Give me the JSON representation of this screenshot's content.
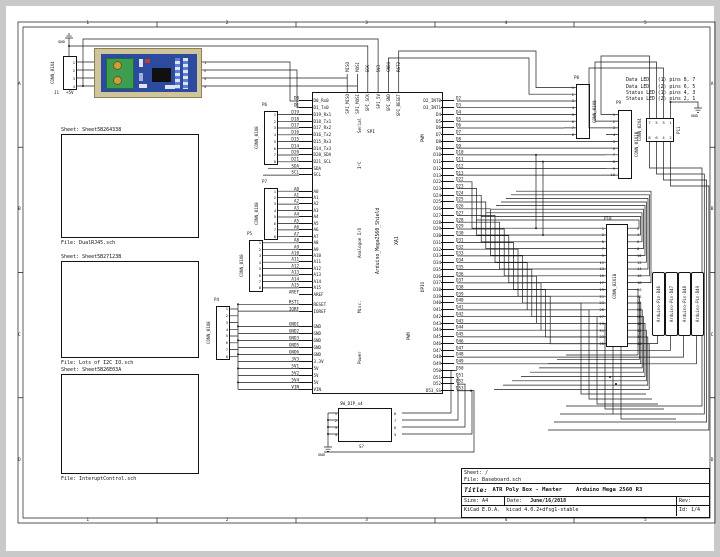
{
  "frame": {
    "cols": [
      "1",
      "2",
      "3",
      "4",
      "5"
    ],
    "rows": [
      "A",
      "B",
      "C",
      "D"
    ]
  },
  "title_block": {
    "sheet": "Sheet: /",
    "file": "File: Baseboard.sch",
    "title_label": "Title:",
    "title": "ATR Poly Box - Master",
    "subtitle": "Arduino Mega 2560 R3",
    "size": "Size: A4",
    "date_label": "Date:",
    "date": "June/16/2018",
    "rev": "Rev:",
    "kicad": "KiCad E.D.A.  kicad 4.0.2+dfsg1-stable",
    "id": "Id: 1/4"
  },
  "notes": [
    "Data LED   (1) pins 8, 7",
    "Data LED   (2) pins 6, 5",
    "Status LED (1) pins 4, 3",
    "Status LED (2) pins 2, 1"
  ],
  "sheets": [
    {
      "name": "Sheet: Sheet5B264338",
      "file": "File: DualRJ45.sch"
    },
    {
      "name": "Sheet: Sheet5B27123B",
      "file": "File: Lots of I2C IO.sch"
    },
    {
      "name": "Sheet: Sheet5B26E03A",
      "file": "File: InteruptControl.sch"
    }
  ],
  "j1": {
    "ref": "J1",
    "value": "CONN_01X4",
    "gnd": "GND",
    "v5": "+5V",
    "pins": [
      "1",
      "2",
      "3",
      "4"
    ],
    "module_pins": [
      "1",
      "2",
      "3",
      "4"
    ]
  },
  "dip": {
    "ref": "S?",
    "value": "SW_DIP_x4",
    "gnd": "GND",
    "left_pins": [
      "1",
      "2",
      "3",
      "4"
    ],
    "right_pins": [
      "8",
      "7",
      "6",
      "5"
    ]
  },
  "p11_gnd": "GND",
  "arduino": {
    "ref": "XA1",
    "value": "Arduino_Mega2560_Shield",
    "top_group": "SPI",
    "pwm2_label": "PWM",
    "top_pins": [
      {
        "net": "MISO",
        "name": "SPI_MISO"
      },
      {
        "net": "MOSI",
        "name": "SPI_MOSI"
      },
      {
        "net": "SCK",
        "name": "SPI_SCK"
      },
      {
        "net": "5V3",
        "name": "SPI_5V"
      },
      {
        "net": "GND4",
        "name": "SPI_GND"
      },
      {
        "net": "RST2",
        "name": "SPI_RESET"
      }
    ],
    "left_groups": [
      {
        "label": "Serial",
        "pins": [
          {
            "net": "D0",
            "name": "D0_Rx0"
          },
          {
            "net": "D1",
            "name": "D1_Tx0"
          },
          {
            "net": "D19",
            "name": "D19_Rx1"
          },
          {
            "net": "D18",
            "name": "D18_Tx1"
          },
          {
            "net": "D17",
            "name": "D17_Rx2"
          },
          {
            "net": "D16",
            "name": "D16_Tx2"
          },
          {
            "net": "D15",
            "name": "D15_Rx3"
          },
          {
            "net": "D14",
            "name": "D14_Tx3"
          }
        ]
      },
      {
        "label": "I²C",
        "pins": [
          {
            "net": "D20",
            "name": "D20_SDA"
          },
          {
            "net": "D21",
            "name": "D21_SCL"
          },
          {
            "net": "SDA",
            "name": "SDA"
          },
          {
            "net": "SCL",
            "name": "SCL"
          }
        ]
      },
      {
        "label": "Analogue I/O",
        "pins": [
          {
            "net": "A0",
            "name": "A0"
          },
          {
            "net": "A1",
            "name": "A1"
          },
          {
            "net": "A2",
            "name": "A2"
          },
          {
            "net": "A3",
            "name": "A3"
          },
          {
            "net": "A4",
            "name": "A4"
          },
          {
            "net": "A5",
            "name": "A5"
          },
          {
            "net": "A6",
            "name": "A6"
          },
          {
            "net": "A7",
            "name": "A7"
          },
          {
            "net": "A8",
            "name": "A8"
          },
          {
            "net": "A9",
            "name": "A9"
          },
          {
            "net": "A10",
            "name": "A10"
          },
          {
            "net": "A11",
            "name": "A11"
          },
          {
            "net": "A12",
            "name": "A12"
          },
          {
            "net": "A13",
            "name": "A13"
          },
          {
            "net": "A14",
            "name": "A14"
          },
          {
            "net": "A15",
            "name": "A15"
          },
          {
            "net": "AREF",
            "name": "AREF"
          }
        ]
      },
      {
        "label": "Misc.",
        "pins": [
          {
            "net": "RST1",
            "name": "RESET"
          },
          {
            "net": "IORF",
            "name": "IOREF"
          }
        ]
      },
      {
        "label": "Power",
        "pins": [
          {
            "net": "GND1",
            "name": "GND"
          },
          {
            "net": "GND2",
            "name": "GND"
          },
          {
            "net": "GND3",
            "name": "GND"
          },
          {
            "net": "GND5",
            "name": "GND"
          },
          {
            "net": "GND6",
            "name": "GND"
          },
          {
            "net": "3V3",
            "name": "3.3V"
          },
          {
            "net": "5V1",
            "name": "5V"
          },
          {
            "net": "5V2",
            "name": "5V"
          },
          {
            "net": "5V4",
            "name": "5V"
          },
          {
            "net": "VIN",
            "name": "VIN"
          }
        ]
      }
    ],
    "right_groups": [
      {
        "label": "PWM",
        "pins": [
          {
            "net": "D2",
            "name": "D2_INT0"
          },
          {
            "net": "D3",
            "name": "D3_INT1"
          },
          {
            "net": "D4",
            "name": "D4"
          },
          {
            "net": "D5",
            "name": "D5"
          },
          {
            "net": "D6",
            "name": "D6"
          },
          {
            "net": "D7",
            "name": "D7"
          },
          {
            "net": "D8",
            "name": "D8"
          },
          {
            "net": "D9",
            "name": "D9"
          },
          {
            "net": "D10",
            "name": "D10"
          },
          {
            "net": "D11",
            "name": "D11"
          },
          {
            "net": "D12",
            "name": "D12"
          },
          {
            "net": "D13",
            "name": "D13"
          }
        ]
      },
      {
        "label": "DPIO",
        "pins": [
          {
            "net": "D22",
            "name": "D22"
          },
          {
            "net": "D23",
            "name": "D23"
          },
          {
            "net": "D24",
            "name": "D24"
          },
          {
            "net": "D25",
            "name": "D25"
          },
          {
            "net": "D26",
            "name": "D26"
          },
          {
            "net": "D27",
            "name": "D27"
          },
          {
            "net": "D28",
            "name": "D28"
          },
          {
            "net": "D29",
            "name": "D29"
          },
          {
            "net": "D30",
            "name": "D30"
          },
          {
            "net": "D31",
            "name": "D31"
          },
          {
            "net": "D32",
            "name": "D32"
          },
          {
            "net": "D33",
            "name": "D33"
          },
          {
            "net": "D34",
            "name": "D34"
          },
          {
            "net": "D35",
            "name": "D35"
          },
          {
            "net": "D36",
            "name": "D36"
          },
          {
            "net": "D37",
            "name": "D37"
          },
          {
            "net": "D38",
            "name": "D38"
          },
          {
            "net": "D39",
            "name": "D39"
          },
          {
            "net": "D40",
            "name": "D40"
          },
          {
            "net": "D41",
            "name": "D41"
          },
          {
            "net": "D42",
            "name": "D42"
          },
          {
            "net": "D43",
            "name": "D43"
          },
          {
            "net": "D44",
            "name": "D44"
          },
          {
            "net": "D45",
            "name": "D45"
          },
          {
            "net": "D46",
            "name": "D46"
          },
          {
            "net": "D47",
            "name": "D47"
          },
          {
            "net": "D48",
            "name": "D48"
          },
          {
            "net": "D49",
            "name": "D49"
          },
          {
            "net": "D50",
            "name": "D50"
          },
          {
            "net": "D51",
            "name": "D51"
          },
          {
            "net": "D52",
            "name": "D52"
          },
          {
            "net": "D53",
            "name": "D53_SS"
          }
        ]
      }
    ]
  },
  "connectors": {
    "p4": {
      "ref": "P4",
      "value": "CONN_01X8",
      "pins": [
        "1",
        "2",
        "3",
        "4",
        "5",
        "6",
        "7",
        "8"
      ]
    },
    "p5": {
      "ref": "P5",
      "value": "CONN_01X8",
      "pins": [
        "1",
        "2",
        "3",
        "4",
        "5",
        "6",
        "7",
        "8"
      ]
    },
    "p6": {
      "ref": "P6",
      "value": "CONN_01X8",
      "pins": [
        "1",
        "2",
        "3",
        "4",
        "5",
        "6",
        "7",
        "8"
      ]
    },
    "p7": {
      "ref": "P7",
      "value": "CONN_01X8",
      "pins": [
        "1",
        "2",
        "3",
        "4",
        "5",
        "6",
        "7",
        "8"
      ]
    },
    "p8": {
      "ref": "P8",
      "value": "CONN_01X8",
      "pins": [
        "1",
        "2",
        "3",
        "4",
        "5",
        "6",
        "7",
        "8"
      ]
    },
    "p9": {
      "ref": "P9",
      "value": "CONN_01X10",
      "pins": [
        "1",
        "2",
        "3",
        "4",
        "5",
        "6",
        "7",
        "8",
        "9",
        "10"
      ]
    },
    "p10": {
      "ref": "P10",
      "value": "CONN_02X18",
      "left_pins": [
        "1",
        "3",
        "5",
        "7",
        "9",
        "11",
        "13",
        "15",
        "17",
        "19",
        "21",
        "23",
        "25",
        "27",
        "29",
        "31",
        "33",
        "35"
      ],
      "right_pins": [
        "2",
        "4",
        "6",
        "8",
        "10",
        "12",
        "14",
        "16",
        "18",
        "20",
        "22",
        "24",
        "26",
        "28",
        "30",
        "32",
        "34",
        "36"
      ]
    },
    "p11": {
      "ref": "P11",
      "value": "CONN_02X4",
      "top_pins": [
        "7",
        "5",
        "3",
        "1"
      ],
      "bottom_pins": [
        "8",
        "6",
        "4",
        "2"
      ]
    }
  },
  "global_labels": [
    "Arduino-Pin-D46",
    "Arduino-Pin-D47",
    "Arduino-Pin-D48",
    "Arduino-Pin-D49"
  ],
  "colors": {
    "wire": "#1c1c1c",
    "module_frame": "#cfc49a",
    "module_board": "#2c4a9e",
    "module_terminal": "#3d9e52",
    "module_screw": "#c6a23c"
  }
}
